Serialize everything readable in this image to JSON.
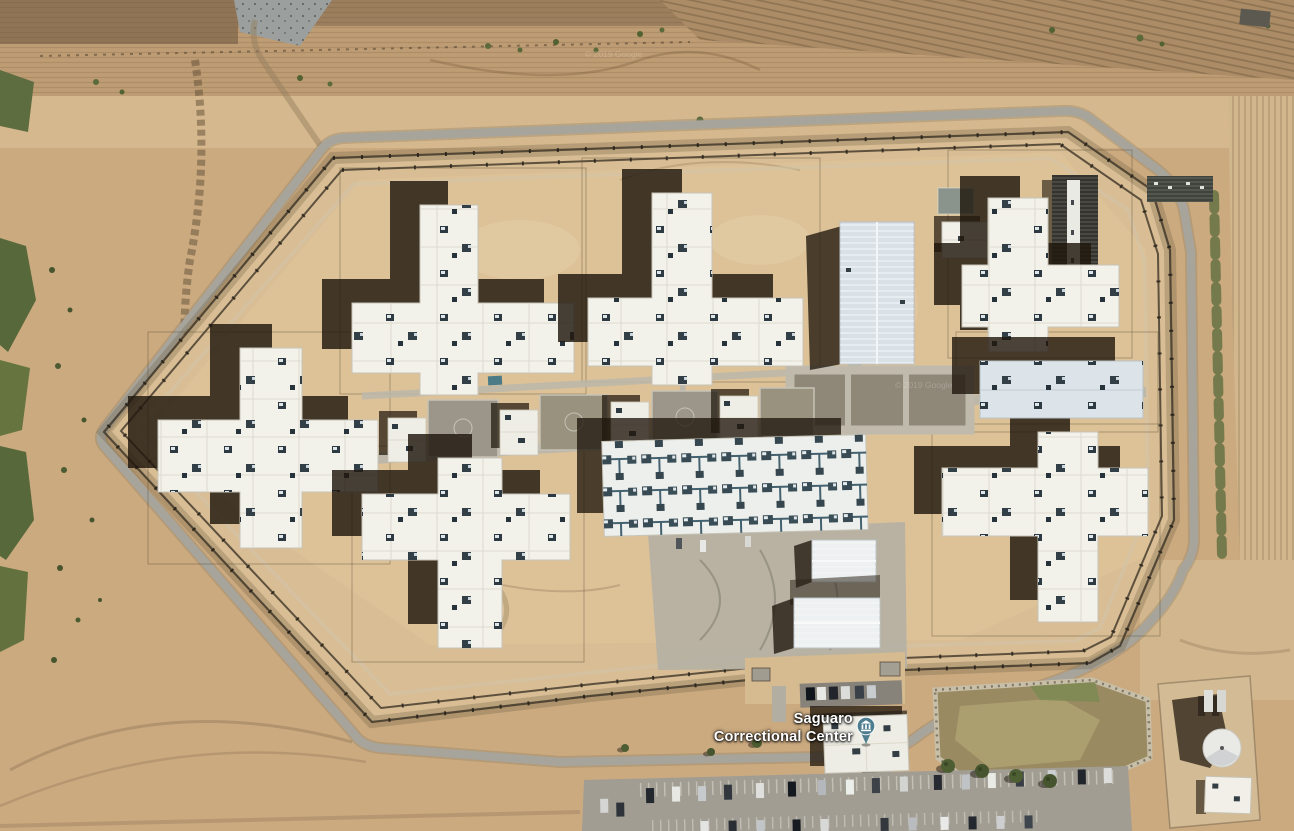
{
  "map": {
    "view_type": "satellite-imagery",
    "poi": {
      "full_name": "Saguaro Correctional Center",
      "label_line1": "Saguaro",
      "label_line2": "Correctional Center",
      "icon": "civic-building-icon",
      "pin_color": "#4d7d8e",
      "glyph_color": "#ffffff",
      "label_color": "#ffffff"
    },
    "watermarks": [
      "© 2019 Google",
      "© 2019 Google"
    ],
    "palette": {
      "desert": "#cbaa80",
      "desert_inner": "#d9bd94",
      "road": "#a7a49b",
      "roof_white": "#f2f1ea",
      "roof_blue": "#dce4e9",
      "shadow": "#221a10",
      "concrete": "#bcb7a9",
      "vegetation": "#57683b"
    }
  }
}
